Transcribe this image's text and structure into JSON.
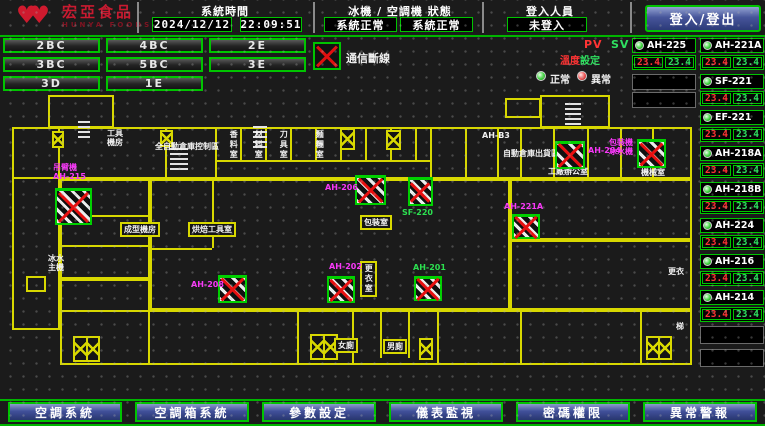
{
  "header": {
    "logo": {
      "title": "宏亞食品",
      "subtitle": "HUNYA FOODS",
      "icon": "double-heart"
    },
    "system_time": {
      "label": "系統時間",
      "date": "2024/12/12",
      "time": "22:09:51"
    },
    "machine_status": {
      "label": "冰機 / 空調機 狀態",
      "chiller_status": "系統正常",
      "ahu_status": "系統正常"
    },
    "login": {
      "label": "登入人員",
      "value": "未登入",
      "button_label": "登入/登出"
    }
  },
  "floor_buttons": {
    "rows": [
      [
        "2BC",
        "4BC",
        "2E"
      ],
      [
        "3BC",
        "5BC",
        "3E"
      ],
      [
        "3D",
        "1E"
      ]
    ]
  },
  "legend": {
    "comm_loss": "通信斷線",
    "normal": "正常",
    "abnormal": "異常",
    "pv_label": "PV",
    "sv_label": "SV",
    "temp_label": "溫度",
    "set_label": "設定"
  },
  "units": {
    "left_column": [
      {
        "name": "AH-225",
        "pv": "23.4",
        "sv": "23.4",
        "status": "normal"
      }
    ],
    "right_column": [
      {
        "name": "AH-221A",
        "pv": "23.4",
        "sv": "23.4",
        "status": "normal"
      },
      {
        "name": "SF-221",
        "pv": "23.4",
        "sv": "23.4",
        "status": "normal"
      },
      {
        "name": "EF-221",
        "pv": "23.4",
        "sv": "23.4",
        "status": "normal"
      },
      {
        "name": "AH-218A",
        "pv": "23.4",
        "sv": "23.4",
        "status": "normal"
      },
      {
        "name": "AH-218B",
        "pv": "23.4",
        "sv": "23.4",
        "status": "normal"
      },
      {
        "name": "AH-224",
        "pv": "23.4",
        "sv": "23.4",
        "status": "normal"
      },
      {
        "name": "AH-216",
        "pv": "23.4",
        "sv": "23.4",
        "status": "normal"
      },
      {
        "name": "AH-214",
        "pv": "23.4",
        "sv": "23.4",
        "status": "normal"
      }
    ]
  },
  "floor_plan": {
    "rooms": [
      {
        "label": "工具\n機房",
        "x": 107,
        "y": 129,
        "kind": "plain"
      },
      {
        "label": "全自動倉庫控制區",
        "x": 155,
        "y": 142,
        "kind": "plain"
      },
      {
        "label": "香料室",
        "x": 229,
        "y": 130,
        "kind": "vert"
      },
      {
        "label": "材料室",
        "x": 254,
        "y": 130,
        "kind": "vert"
      },
      {
        "label": "刀具室",
        "x": 279,
        "y": 130,
        "kind": "vert"
      },
      {
        "label": "麵糰室",
        "x": 315,
        "y": 130,
        "kind": "vert"
      },
      {
        "label": "AH-B3",
        "x": 482,
        "y": 131,
        "kind": "plain"
      },
      {
        "label": "自動倉庫出貨區",
        "x": 503,
        "y": 149,
        "kind": "plain"
      },
      {
        "label": "工廠辦公室",
        "x": 548,
        "y": 167,
        "kind": "plain"
      },
      {
        "label": "機械室",
        "x": 641,
        "y": 168,
        "kind": "plain"
      },
      {
        "label": "成型機房",
        "x": 120,
        "y": 222,
        "kind": "boxed"
      },
      {
        "label": "烘焙工具室",
        "x": 188,
        "y": 222,
        "kind": "boxed"
      },
      {
        "label": "包裝室",
        "x": 360,
        "y": 215,
        "kind": "boxed"
      },
      {
        "label": "更衣室",
        "x": 360,
        "y": 261,
        "kind": "boxed-vert"
      },
      {
        "label": "女廁",
        "x": 334,
        "y": 338,
        "kind": "boxed"
      },
      {
        "label": "男廁",
        "x": 383,
        "y": 339,
        "kind": "boxed"
      },
      {
        "label": "冰水\n主機",
        "x": 48,
        "y": 254,
        "kind": "plain"
      },
      {
        "label": "更衣",
        "x": 668,
        "y": 267,
        "kind": "plain"
      },
      {
        "label": "梯",
        "x": 676,
        "y": 322,
        "kind": "plain"
      }
    ],
    "equipment": [
      {
        "id": "AH-215",
        "x": 55,
        "y": 188,
        "w": 37,
        "h": 37,
        "label": "吊臂機\nAH-215",
        "lc": "m",
        "lx": 53,
        "ly": 163
      },
      {
        "id": "AH-208",
        "x": 218,
        "y": 275,
        "w": 29,
        "h": 28,
        "label": "AH-208",
        "lc": "m",
        "lx": 191,
        "ly": 280
      },
      {
        "id": "AH-206",
        "x": 355,
        "y": 175,
        "w": 31,
        "h": 30,
        "label": "AH-206",
        "lc": "m",
        "lx": 325,
        "ly": 183
      },
      {
        "id": "SF-220",
        "x": 408,
        "y": 177,
        "w": 25,
        "h": 29,
        "label": "SF-220",
        "lc": "g",
        "lx": 402,
        "ly": 208
      },
      {
        "id": "AH-202",
        "x": 327,
        "y": 276,
        "w": 28,
        "h": 27,
        "label": "AH-202",
        "lc": "m",
        "lx": 329,
        "ly": 262
      },
      {
        "id": "AH-201",
        "x": 414,
        "y": 276,
        "w": 28,
        "h": 25,
        "label": "AH-201",
        "lc": "g",
        "lx": 413,
        "ly": 263
      },
      {
        "id": "AH-221A",
        "x": 512,
        "y": 214,
        "w": 28,
        "h": 25,
        "label": "AH-221A",
        "lc": "m",
        "lx": 504,
        "ly": 202
      },
      {
        "id": "AH-204",
        "x": 555,
        "y": 141,
        "w": 30,
        "h": 28,
        "label": "AH-204",
        "lc": "m",
        "lx": 588,
        "ly": 146
      },
      {
        "id": "CH-1",
        "x": 637,
        "y": 139,
        "w": 29,
        "h": 29,
        "label": "包裝機\n冰水機",
        "lc": "m",
        "lx": 609,
        "ly": 138
      }
    ],
    "walls": [
      [
        48,
        95,
        66,
        33
      ],
      [
        540,
        95,
        70,
        33
      ],
      [
        505,
        98,
        36,
        20
      ],
      [
        12,
        127,
        680,
        52
      ],
      [
        12,
        127,
        48,
        203
      ],
      [
        60,
        179,
        90,
        100
      ],
      [
        150,
        179,
        360,
        131
      ],
      [
        510,
        179,
        182,
        61
      ],
      [
        510,
        240,
        182,
        70
      ],
      [
        60,
        310,
        632,
        55
      ],
      [
        60,
        279,
        90,
        86
      ],
      [
        26,
        276,
        20,
        16
      ]
    ],
    "vlines": [
      [
        165,
        127,
        52
      ],
      [
        215,
        127,
        52
      ],
      [
        240,
        127,
        33
      ],
      [
        265,
        127,
        33
      ],
      [
        290,
        127,
        33
      ],
      [
        315,
        127,
        33
      ],
      [
        340,
        127,
        33
      ],
      [
        365,
        127,
        33
      ],
      [
        390,
        127,
        33
      ],
      [
        415,
        127,
        33
      ],
      [
        430,
        127,
        52
      ],
      [
        465,
        127,
        52
      ],
      [
        497,
        127,
        52
      ],
      [
        520,
        127,
        52
      ],
      [
        553,
        127,
        52
      ],
      [
        587,
        127,
        52
      ],
      [
        620,
        127,
        52
      ],
      [
        652,
        127,
        52
      ],
      [
        212,
        179,
        69
      ],
      [
        297,
        310,
        55
      ],
      [
        352,
        310,
        55
      ],
      [
        380,
        310,
        48
      ],
      [
        408,
        310,
        48
      ],
      [
        437,
        310,
        55
      ],
      [
        520,
        310,
        55
      ],
      [
        640,
        310,
        55
      ]
    ],
    "hlines": [
      [
        215,
        160,
        215
      ],
      [
        60,
        215,
        90
      ],
      [
        60,
        245,
        90
      ],
      [
        150,
        248,
        62
      ]
    ],
    "stairs": [
      [
        340,
        128,
        15,
        22,
        1
      ],
      [
        386,
        130,
        15,
        20,
        1
      ],
      [
        52,
        131,
        12,
        17,
        1
      ],
      [
        160,
        130,
        13,
        17,
        1
      ],
      [
        73,
        336,
        27,
        26,
        2
      ],
      [
        310,
        334,
        28,
        26,
        2
      ],
      [
        419,
        338,
        14,
        22,
        1
      ],
      [
        646,
        336,
        26,
        24,
        2
      ]
    ],
    "glyphs": [
      [
        78,
        118,
        12,
        20
      ],
      [
        253,
        124,
        14,
        24
      ],
      [
        565,
        103,
        16,
        22
      ],
      [
        170,
        146,
        18,
        24
      ]
    ]
  },
  "footer": {
    "buttons": [
      "空調系統",
      "空調箱系統",
      "參數設定",
      "儀表監視",
      "密碼權限",
      "異常警報"
    ]
  },
  "colors": {
    "accent_green": "#00c400",
    "wall_yellow": "#d8d800",
    "alarm_red": "#e81010",
    "magenta": "#f838f8",
    "pv_red": "#ff3434",
    "sv_green": "#2fe060",
    "button_blue": "#41509a",
    "logo_red": "#c81a30"
  }
}
